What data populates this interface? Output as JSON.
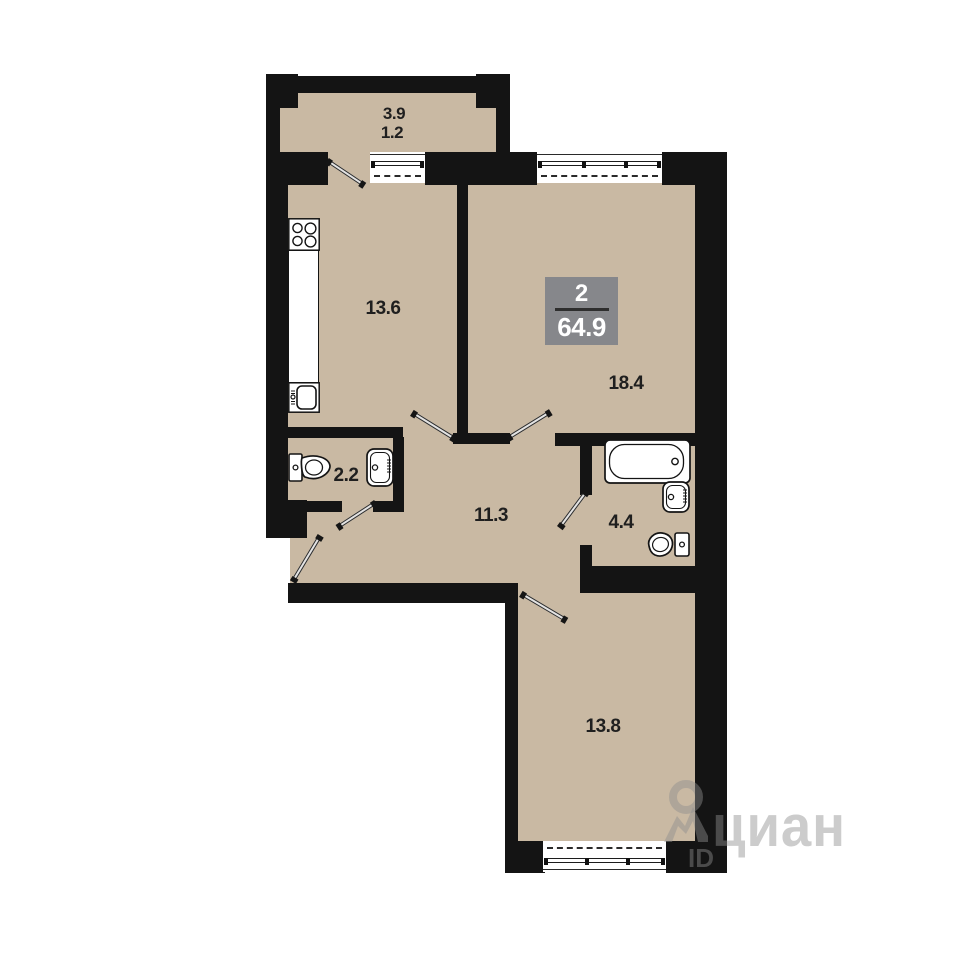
{
  "plan": {
    "badge": {
      "rooms_count": "2",
      "total_area": "64.9"
    },
    "rooms": {
      "balcony_area": "3.9",
      "balcony_reduced_area": "1.2",
      "kitchen": "13.6",
      "living_room": "18.4",
      "wc": "2.2",
      "hallway": "11.3",
      "bathroom": "4.4",
      "bedroom": "13.8"
    },
    "colors": {
      "floor": "#c9b9a3",
      "wall": "#141414",
      "badge_bg": "#86878b",
      "badge_text": "#ffffff"
    }
  },
  "watermark": {
    "brand": "циан",
    "id_label": "ID"
  }
}
